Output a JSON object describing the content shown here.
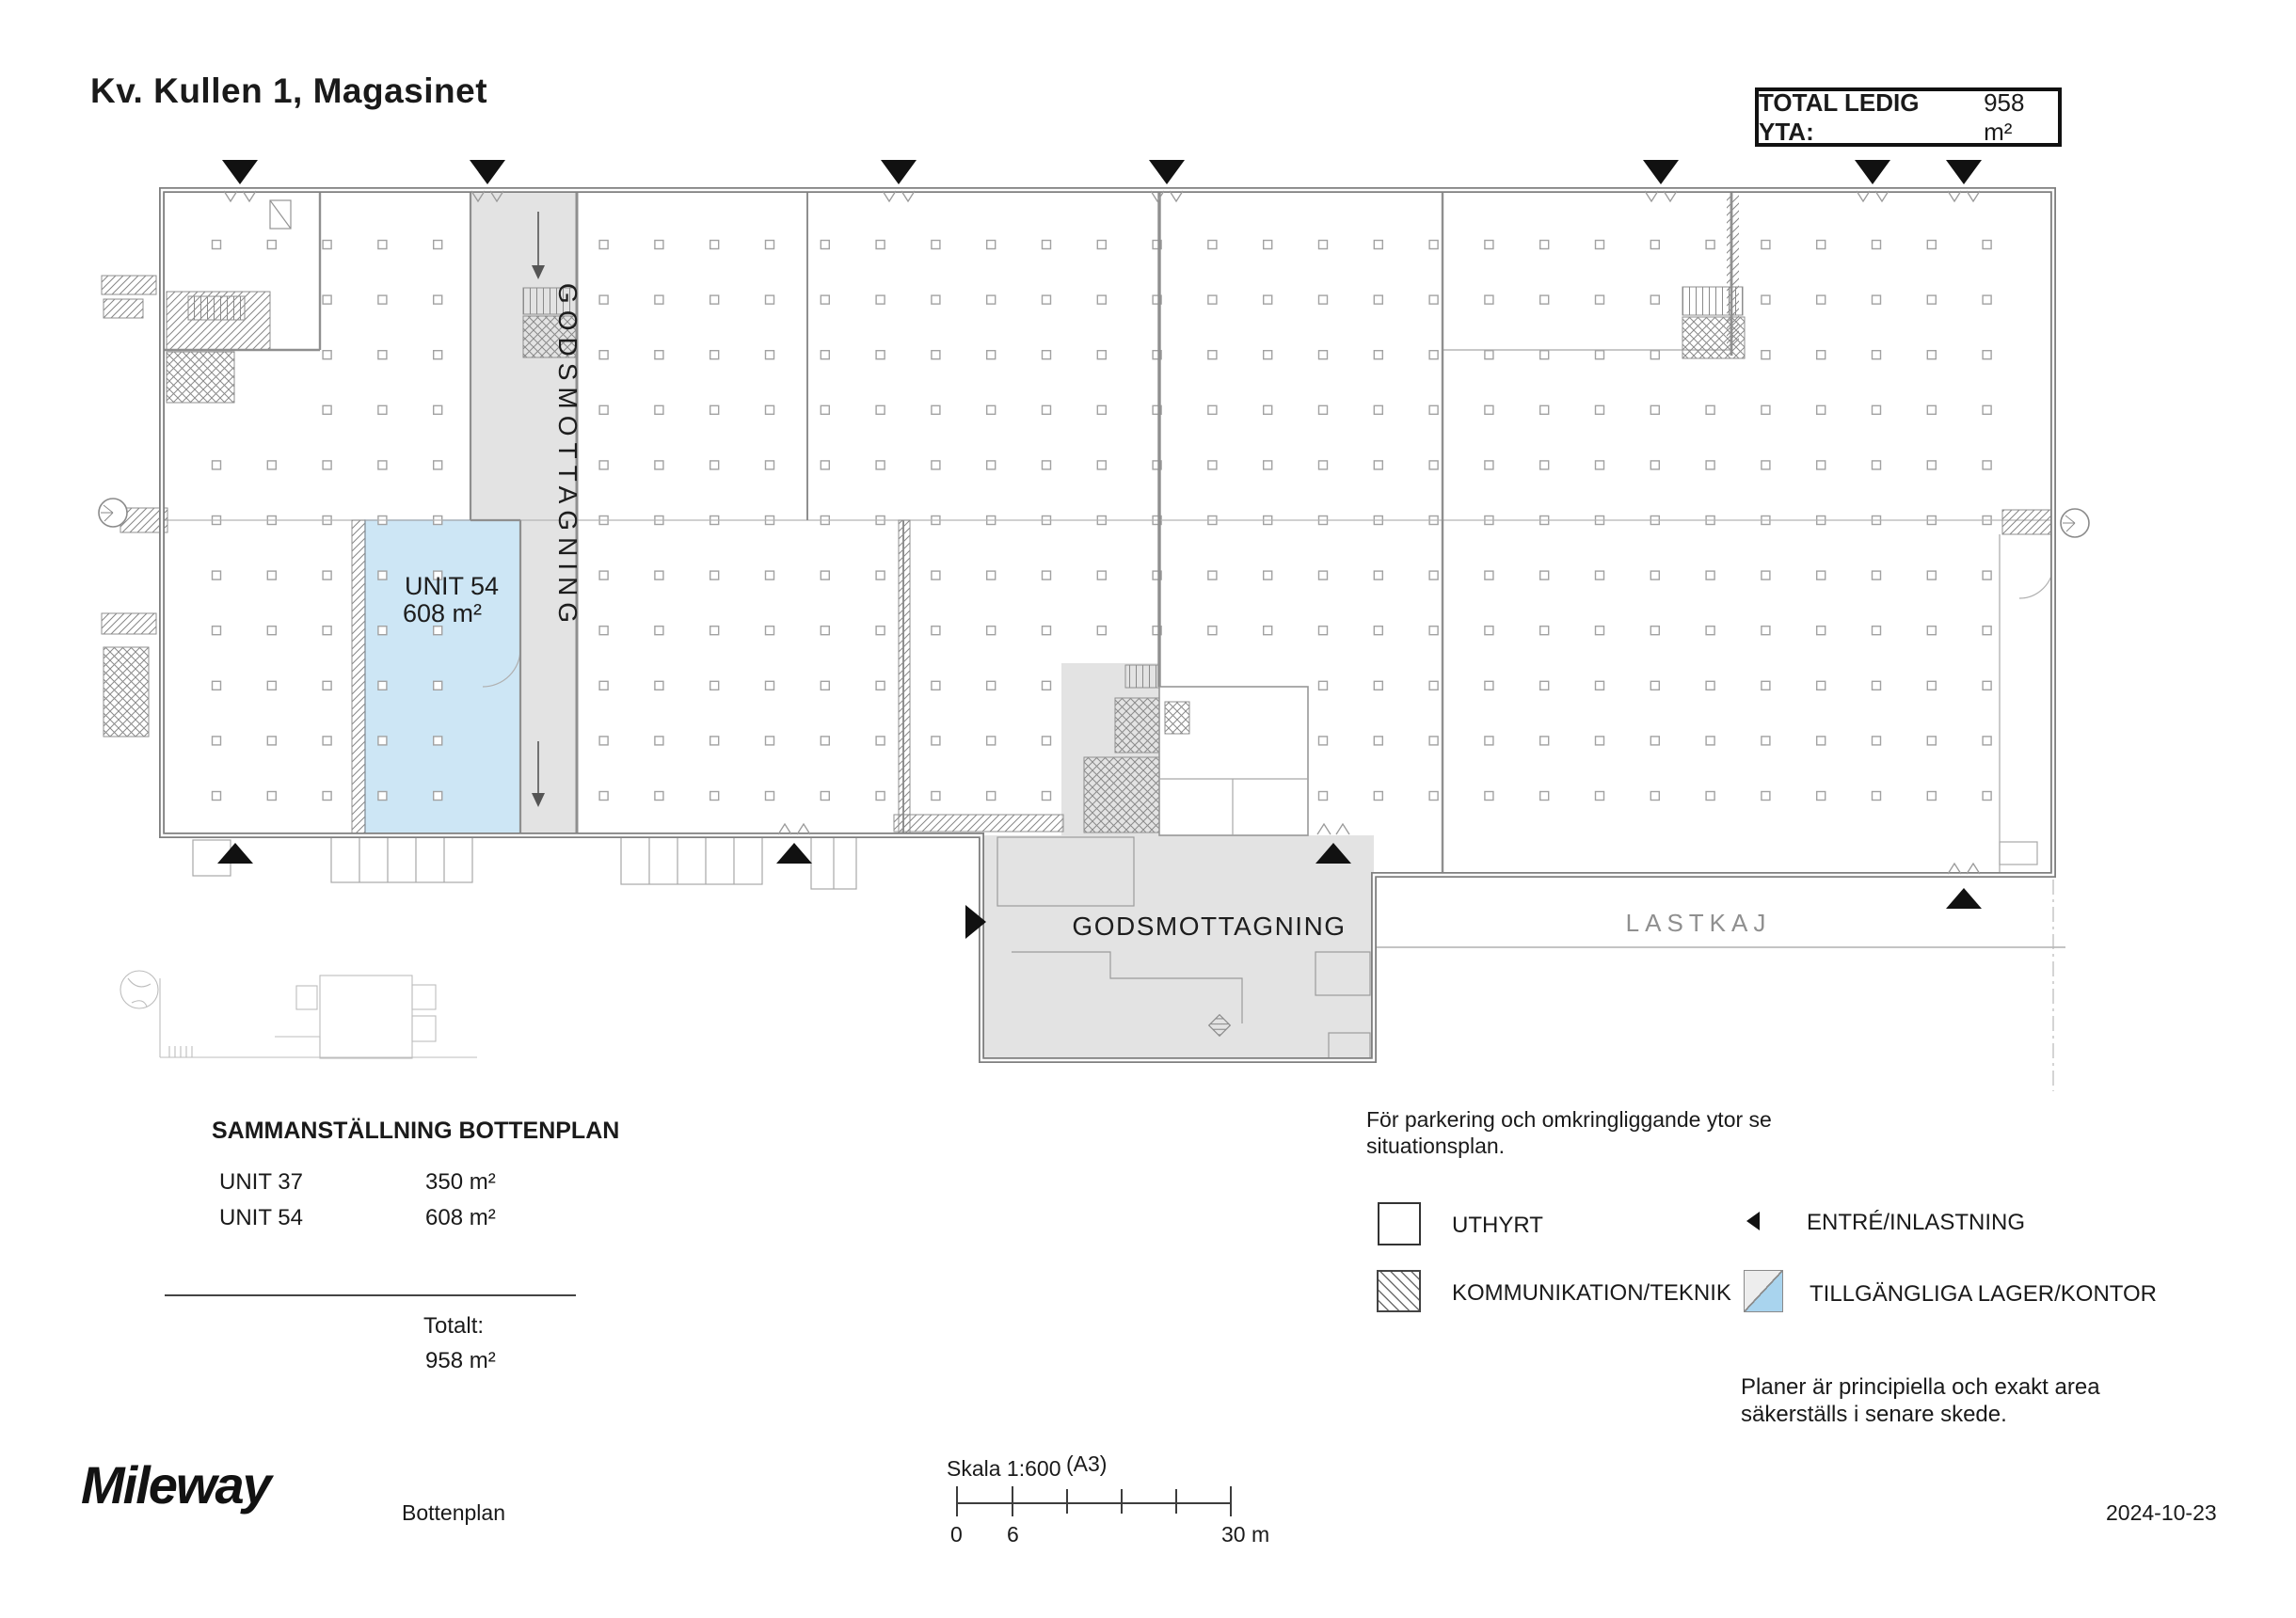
{
  "header": {
    "title": "Kv. Kullen 1, Magasinet",
    "total_label": "TOTAL LEDIG YTA:",
    "total_value": "958 m²"
  },
  "plan": {
    "unit54_name": "UNIT 54",
    "unit54_area": "608 m²",
    "corridor_label": "GODSMOTTAGNING",
    "annex_label": "GODSMOTTAGNING",
    "lastkaj_label": "LASTKAJ"
  },
  "summary": {
    "heading": "SAMMANSTÄLLNING BOTTENPLAN",
    "rows": [
      {
        "unit": "UNIT 37",
        "area": "350 m²"
      },
      {
        "unit": "UNIT 54",
        "area": "608 m²"
      }
    ],
    "total_label": "Totalt:",
    "total_value": "958 m²"
  },
  "notes": {
    "parking_line1": "För parkering och omkringliggande ytor se",
    "parking_line2": "situationsplan.",
    "disclaimer_line1": "Planer är principiella och exakt area",
    "disclaimer_line2": "säkerställs i senare skede."
  },
  "legend": {
    "uthyrt": "UTHYRT",
    "kommunikation": "KOMMUNIKATION/TEKNIK",
    "entre": "ENTRÉ/INLASTNING",
    "tillgangliga": "TILLGÄNGLIGA LAGER/KONTOR"
  },
  "footer": {
    "logo": "Mileway",
    "plan_name": "Bottenplan",
    "scale_label": "Skala 1:600",
    "paper": "(A3)",
    "tick_zero": "0",
    "tick_six": "6",
    "tick_thirty": "30 m",
    "date": "2024-10-23"
  },
  "colors": {
    "available_fill": "#cde6f5",
    "available_border": "#8fb8d6",
    "zone_fill": "#e3e3e3",
    "legend_blue": "#a9d4ee",
    "wall": "#7f7f7f"
  }
}
